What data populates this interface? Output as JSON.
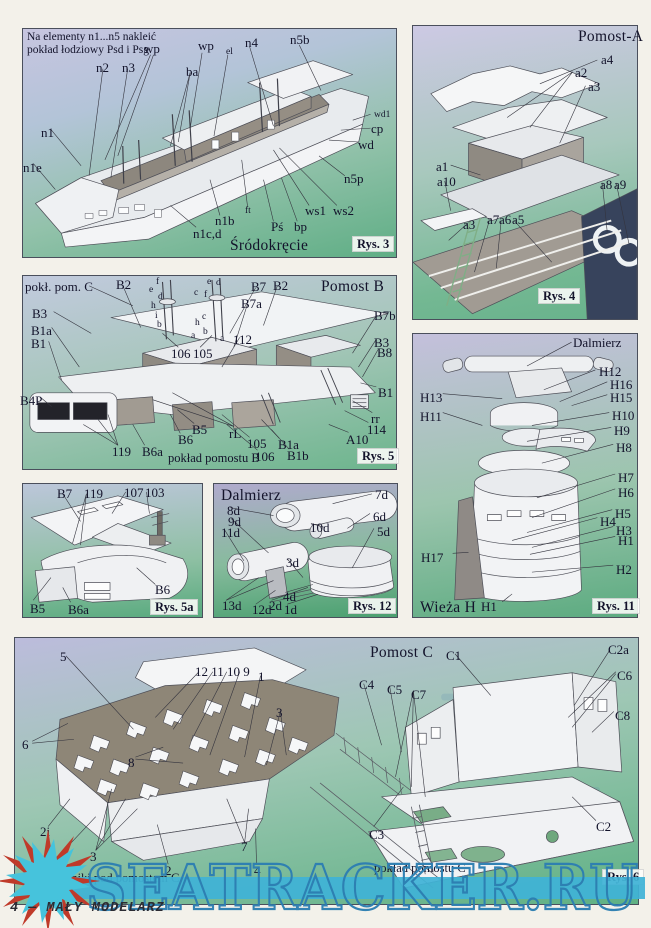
{
  "page": {
    "footer_text": "4 — MAŁY MODELARZ",
    "watermark": {
      "text": "SEATRACKER.RU",
      "outline_color": "#2d7fb2",
      "band_color": "#40b3d6",
      "sun_color": "#46c3dc",
      "spike_color": "#bf3a2a"
    }
  },
  "panels": {
    "rys3": {
      "labels": [
        {
          "t": "Na elementy n1...n5 nakleić\npokład łodziowy Psd i Psg",
          "x": 27,
          "y": 31,
          "c": "note",
          "n": "rys3-note"
        },
        {
          "t": "wp",
          "x": 144,
          "y": 42
        },
        {
          "t": "wp",
          "x": 198,
          "y": 39
        },
        {
          "t": "el",
          "x": 226,
          "y": 47,
          "c": "sm"
        },
        {
          "t": "n4",
          "x": 245,
          "y": 36
        },
        {
          "t": "n5b",
          "x": 290,
          "y": 33
        },
        {
          "t": "n2",
          "x": 96,
          "y": 61
        },
        {
          "t": "n3",
          "x": 122,
          "y": 61
        },
        {
          "t": "ba",
          "x": 186,
          "y": 65
        },
        {
          "t": "wd1",
          "x": 374,
          "y": 110,
          "c": "sm"
        },
        {
          "t": "cp",
          "x": 371,
          "y": 122
        },
        {
          "t": "wd",
          "x": 358,
          "y": 138
        },
        {
          "t": "n5p",
          "x": 344,
          "y": 172
        },
        {
          "t": "ws1",
          "x": 305,
          "y": 204
        },
        {
          "t": "ws2",
          "x": 333,
          "y": 204
        },
        {
          "t": "ft",
          "x": 245,
          "y": 206,
          "c": "sm"
        },
        {
          "t": "n1b",
          "x": 215,
          "y": 214
        },
        {
          "t": "Pś",
          "x": 271,
          "y": 220
        },
        {
          "t": "bp",
          "x": 294,
          "y": 220
        },
        {
          "t": "n1c,d",
          "x": 193,
          "y": 227
        },
        {
          "t": "n1",
          "x": 41,
          "y": 126
        },
        {
          "t": "n1e",
          "x": 23,
          "y": 161
        },
        {
          "t": "Śródokręcie",
          "x": 230,
          "y": 237,
          "c": "title",
          "n": "rys3-title"
        },
        {
          "t": "Rys. 3",
          "x": 352,
          "y": 236,
          "c": "fig",
          "n": "rys3-fig"
        }
      ]
    },
    "rys4": {
      "labels": [
        {
          "t": "Pomost-A",
          "x": 578,
          "y": 28,
          "c": "title",
          "n": "rys4-title"
        },
        {
          "t": "a4",
          "x": 601,
          "y": 53
        },
        {
          "t": "a2",
          "x": 575,
          "y": 66
        },
        {
          "t": "a3",
          "x": 588,
          "y": 80
        },
        {
          "t": "a1",
          "x": 436,
          "y": 160
        },
        {
          "t": "a10",
          "x": 437,
          "y": 175
        },
        {
          "t": "a3",
          "x": 463,
          "y": 218
        },
        {
          "t": "a7",
          "x": 487,
          "y": 213
        },
        {
          "t": "a6",
          "x": 499,
          "y": 213
        },
        {
          "t": "a5",
          "x": 512,
          "y": 213
        },
        {
          "t": "a8",
          "x": 600,
          "y": 178
        },
        {
          "t": "a9",
          "x": 614,
          "y": 178
        },
        {
          "t": "Rys. 4",
          "x": 538,
          "y": 288,
          "c": "fig",
          "n": "rys4-fig"
        }
      ]
    },
    "rys5": {
      "labels": [
        {
          "t": "pokł. pom. C",
          "x": 25,
          "y": 280
        },
        {
          "t": "B2",
          "x": 116,
          "y": 278
        },
        {
          "t": "B3",
          "x": 32,
          "y": 307
        },
        {
          "t": "B1a",
          "x": 31,
          "y": 324
        },
        {
          "t": "B1",
          "x": 31,
          "y": 337
        },
        {
          "t": "B4P",
          "x": 20,
          "y": 394
        },
        {
          "t": "f",
          "x": 156,
          "y": 277,
          "c": "sm"
        },
        {
          "t": "e",
          "x": 149,
          "y": 285,
          "c": "sm"
        },
        {
          "t": "d",
          "x": 158,
          "y": 292,
          "c": "sm"
        },
        {
          "t": "c",
          "x": 194,
          "y": 288,
          "c": "sm"
        },
        {
          "t": "h",
          "x": 151,
          "y": 301,
          "c": "sm"
        },
        {
          "t": "i",
          "x": 155,
          "y": 311,
          "c": "sm"
        },
        {
          "t": "b",
          "x": 157,
          "y": 320,
          "c": "sm"
        },
        {
          "t": "a",
          "x": 191,
          "y": 331,
          "c": "sm"
        },
        {
          "t": "h",
          "x": 195,
          "y": 318,
          "c": "sm"
        },
        {
          "t": "e",
          "x": 207,
          "y": 277,
          "c": "sm"
        },
        {
          "t": "d",
          "x": 216,
          "y": 278,
          "c": "sm"
        },
        {
          "t": "f",
          "x": 204,
          "y": 290,
          "c": "sm"
        },
        {
          "t": "c",
          "x": 202,
          "y": 312,
          "c": "sm"
        },
        {
          "t": "b",
          "x": 203,
          "y": 327,
          "c": "sm"
        },
        {
          "t": "a",
          "x": 220,
          "y": 334,
          "c": "sm"
        },
        {
          "t": "106",
          "x": 171,
          "y": 347
        },
        {
          "t": "105",
          "x": 193,
          "y": 347
        },
        {
          "t": "112",
          "x": 233,
          "y": 333
        },
        {
          "t": "B7",
          "x": 251,
          "y": 280
        },
        {
          "t": "B2",
          "x": 273,
          "y": 279
        },
        {
          "t": "Pomost B",
          "x": 321,
          "y": 278,
          "c": "title",
          "n": "rys5-title"
        },
        {
          "t": "B7a",
          "x": 241,
          "y": 297
        },
        {
          "t": "B7b",
          "x": 374,
          "y": 309
        },
        {
          "t": "B3",
          "x": 374,
          "y": 336
        },
        {
          "t": "B8",
          "x": 377,
          "y": 346
        },
        {
          "t": "B1",
          "x": 378,
          "y": 386
        },
        {
          "t": "rr",
          "x": 371,
          "y": 412
        },
        {
          "t": "114",
          "x": 367,
          "y": 423
        },
        {
          "t": "A10",
          "x": 346,
          "y": 433
        },
        {
          "t": "rL",
          "x": 229,
          "y": 427
        },
        {
          "t": "105",
          "x": 247,
          "y": 437
        },
        {
          "t": "106",
          "x": 255,
          "y": 450
        },
        {
          "t": "B1a",
          "x": 278,
          "y": 438
        },
        {
          "t": "B1b",
          "x": 287,
          "y": 449
        },
        {
          "t": "B5",
          "x": 192,
          "y": 423
        },
        {
          "t": "B6",
          "x": 178,
          "y": 433
        },
        {
          "t": "119",
          "x": 112,
          "y": 445
        },
        {
          "t": "B6a",
          "x": 142,
          "y": 445
        },
        {
          "t": "pokład pomostu B",
          "x": 168,
          "y": 451,
          "c": "cap",
          "n": "rys5-caption"
        },
        {
          "t": "Rys. 5",
          "x": 357,
          "y": 448,
          "c": "fig",
          "n": "rys5-fig"
        }
      ]
    },
    "rys5a": {
      "labels": [
        {
          "t": "B7",
          "x": 57,
          "y": 487
        },
        {
          "t": "119",
          "x": 84,
          "y": 487
        },
        {
          "t": "107",
          "x": 124,
          "y": 486
        },
        {
          "t": "103",
          "x": 145,
          "y": 486
        },
        {
          "t": "B6",
          "x": 155,
          "y": 583
        },
        {
          "t": "B5",
          "x": 30,
          "y": 602
        },
        {
          "t": "B6a",
          "x": 68,
          "y": 603
        },
        {
          "t": "Rys. 5a",
          "x": 150,
          "y": 599,
          "c": "fig",
          "n": "rys5a-fig"
        }
      ]
    },
    "rys12": {
      "labels": [
        {
          "t": "Dalmierz",
          "x": 221,
          "y": 487,
          "c": "title",
          "n": "rys12-title"
        },
        {
          "t": "7d",
          "x": 375,
          "y": 488
        },
        {
          "t": "8d",
          "x": 227,
          "y": 504
        },
        {
          "t": "9d",
          "x": 228,
          "y": 515
        },
        {
          "t": "11d",
          "x": 221,
          "y": 526
        },
        {
          "t": "10d",
          "x": 310,
          "y": 521
        },
        {
          "t": "6d",
          "x": 373,
          "y": 510
        },
        {
          "t": "5d",
          "x": 377,
          "y": 525
        },
        {
          "t": "3d",
          "x": 286,
          "y": 556
        },
        {
          "t": "13d",
          "x": 222,
          "y": 599
        },
        {
          "t": "12d",
          "x": 252,
          "y": 603
        },
        {
          "t": "2d",
          "x": 269,
          "y": 599
        },
        {
          "t": "4d",
          "x": 283,
          "y": 590
        },
        {
          "t": "1d",
          "x": 284,
          "y": 603
        },
        {
          "t": "Rys. 12",
          "x": 348,
          "y": 598,
          "c": "fig",
          "n": "rys12-fig"
        }
      ]
    },
    "rys11": {
      "labels": [
        {
          "t": "Dalmierz",
          "x": 573,
          "y": 336,
          "n": "rys11-dalmierz-label"
        },
        {
          "t": "H12",
          "x": 599,
          "y": 365
        },
        {
          "t": "H16",
          "x": 610,
          "y": 378
        },
        {
          "t": "H13",
          "x": 420,
          "y": 391
        },
        {
          "t": "H15",
          "x": 610,
          "y": 391
        },
        {
          "t": "H11",
          "x": 420,
          "y": 410
        },
        {
          "t": "H10",
          "x": 612,
          "y": 409
        },
        {
          "t": "H9",
          "x": 614,
          "y": 424
        },
        {
          "t": "H8",
          "x": 616,
          "y": 441
        },
        {
          "t": "H7",
          "x": 618,
          "y": 471
        },
        {
          "t": "H6",
          "x": 618,
          "y": 486
        },
        {
          "t": "H5",
          "x": 615,
          "y": 507
        },
        {
          "t": "H4",
          "x": 600,
          "y": 515
        },
        {
          "t": "H3",
          "x": 616,
          "y": 524
        },
        {
          "t": "H1",
          "x": 618,
          "y": 534
        },
        {
          "t": "H17",
          "x": 421,
          "y": 551
        },
        {
          "t": "H2",
          "x": 616,
          "y": 563
        },
        {
          "t": "H1",
          "x": 481,
          "y": 600
        },
        {
          "t": "Wieża H",
          "x": 420,
          "y": 599,
          "c": "title",
          "n": "rys11-title"
        },
        {
          "t": "Rys. 11",
          "x": 592,
          "y": 598,
          "c": "fig",
          "n": "rys11-fig"
        }
      ]
    },
    "rys6": {
      "labels": [
        {
          "t": "Pomost C",
          "x": 370,
          "y": 644,
          "c": "title",
          "n": "rys6-title"
        },
        {
          "t": "5",
          "x": 60,
          "y": 650
        },
        {
          "t": "12 11 10 9",
          "x": 195,
          "y": 665
        },
        {
          "t": "1",
          "x": 258,
          "y": 670
        },
        {
          "t": "3",
          "x": 276,
          "y": 706
        },
        {
          "t": "6",
          "x": 22,
          "y": 738
        },
        {
          "t": "8",
          "x": 128,
          "y": 756
        },
        {
          "t": "2i",
          "x": 40,
          "y": 825
        },
        {
          "t": "1",
          "x": 60,
          "y": 849
        },
        {
          "t": "3",
          "x": 90,
          "y": 850
        },
        {
          "t": "2",
          "x": 165,
          "y": 864
        },
        {
          "t": "7",
          "x": 241,
          "y": 840
        },
        {
          "t": "4",
          "x": 254,
          "y": 864
        },
        {
          "t": "Wsporniki pod pomostem C",
          "x": 38,
          "y": 871,
          "c": "cap",
          "n": "rys6-caption-left"
        },
        {
          "t": "C1",
          "x": 446,
          "y": 649
        },
        {
          "t": "C2a",
          "x": 608,
          "y": 643
        },
        {
          "t": "C6",
          "x": 617,
          "y": 669
        },
        {
          "t": "C4",
          "x": 359,
          "y": 678
        },
        {
          "t": "C5",
          "x": 387,
          "y": 683
        },
        {
          "t": "C7",
          "x": 411,
          "y": 688
        },
        {
          "t": "C8",
          "x": 615,
          "y": 709
        },
        {
          "t": "C3",
          "x": 369,
          "y": 828
        },
        {
          "t": "C2",
          "x": 596,
          "y": 820
        },
        {
          "t": "pokład pomostu C",
          "x": 374,
          "y": 861,
          "c": "cap",
          "n": "rys6-caption-right"
        },
        {
          "t": "Rys. 6",
          "x": 602,
          "y": 869,
          "c": "fig",
          "n": "rys6-fig"
        }
      ]
    }
  }
}
